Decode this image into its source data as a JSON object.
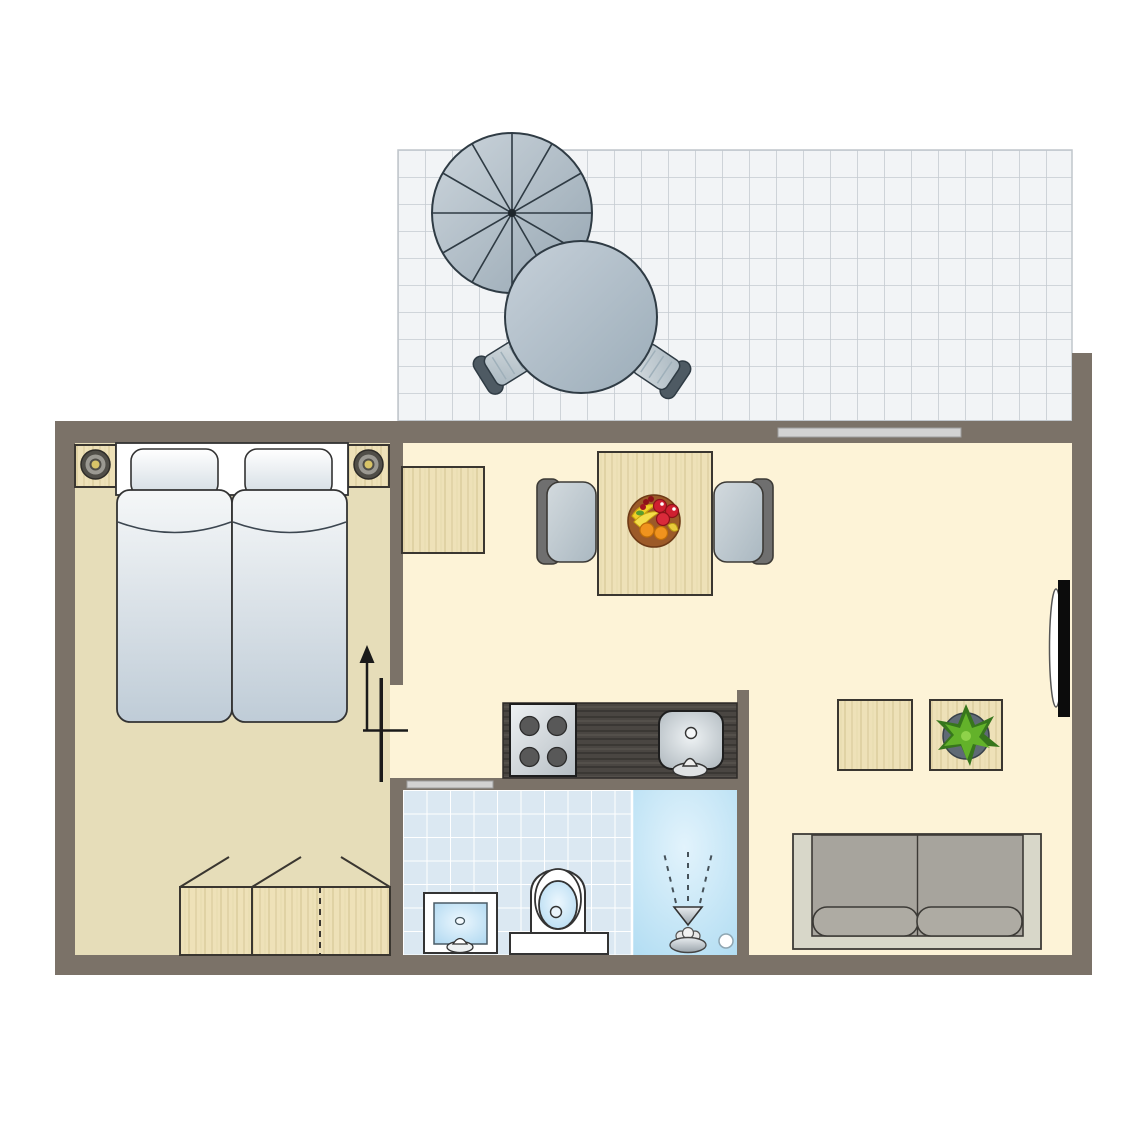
{
  "meta": {
    "type": "floor-plan",
    "description": "Top-down floor plan of a studio holiday apartment: tiled terrace with parasol, round table and two chairs at the top; bedroom with double bed, two nightstand lamps and wardrobe on the left; open living-dining area with dining table, two chairs, fruit bowl, wall cabinet, two side tables, potted plant, sofa and wall-mounted TV on the right; kitchen block with 4-burner stove and sink; bathroom with washbasin, toilet and shower"
  },
  "colors": {
    "wall": "#7b7268",
    "floorBedroom": "#e6ddb9",
    "floorLiving": "#fdf3d7",
    "terraceTile": "#f2f4f6",
    "terraceTileLine": "#c5cbd1",
    "bathroomTile": "#dbe8f2",
    "showerBlue": "#bfe2f4",
    "counterDarkWood": "#4a4642",
    "furnitureWood": "#eee1b8",
    "doorBar": "#d2d2d2",
    "grayFurniture": "#a7a49d",
    "sofaFrame": "#d8d7c9",
    "chairSeat": "#b9c6cf",
    "chairBack": "#6f6f6f",
    "outdoorGray": "#a9b7c1",
    "outdoorDark": "#4e5a63",
    "lampYellow": "#d9c468",
    "tvBlack": "#0c0c0c",
    "plantDark": "#37761c",
    "plantLight": "#63b22a",
    "plantPot": "#5f6a75",
    "apple": "#cf2030",
    "orange": "#f0931e",
    "banana": "#f2d029",
    "bowl": "#9c5a28",
    "doorLine": "#1a1a1a"
  },
  "rooms": {
    "terrace": {
      "label": "terrace",
      "items": [
        "parasol",
        "round-table",
        "terrace-chair",
        "terrace-chair"
      ]
    },
    "bedroom": {
      "label": "bedroom",
      "items": [
        "double-bed",
        "pillow",
        "pillow",
        "nightstand-lamp",
        "nightstand-lamp",
        "wardrobe"
      ]
    },
    "living_dining": {
      "label": "living-dining",
      "items": [
        "wall-cabinet",
        "dining-table",
        "dining-chair",
        "dining-chair",
        "fruit-bowl",
        "side-table",
        "side-table",
        "potted-plant",
        "sofa",
        "tv"
      ]
    },
    "kitchen": {
      "label": "kitchen",
      "items": [
        "counter",
        "stove-4-burners",
        "sink"
      ]
    },
    "bathroom": {
      "label": "bathroom",
      "items": [
        "washbasin",
        "toilet",
        "shower",
        "drain"
      ]
    }
  },
  "counts": {
    "beds": 2,
    "pillows": 2,
    "stove_burners": 4,
    "dining_chairs": 2,
    "terrace_chairs": 2,
    "side_tables": 2,
    "sofa_seats": 2,
    "doors": 3
  }
}
